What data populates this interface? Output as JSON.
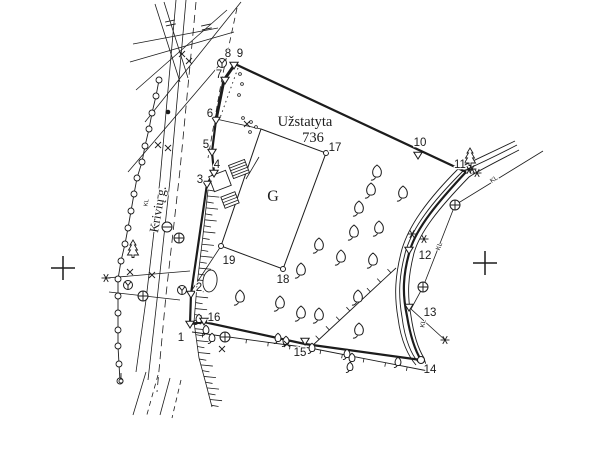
{
  "map": {
    "width": 600,
    "height": 450,
    "colors": {
      "ink": "#1c1c1c",
      "bg": "#ffffff"
    },
    "texts": [
      {
        "id": "builtup-label",
        "text": "Užstatyta",
        "x": 305,
        "y": 126,
        "size": 14.5,
        "font": "serif",
        "rot": 0
      },
      {
        "id": "builtup-area-value",
        "text": "736",
        "x": 313,
        "y": 142,
        "size": 14.5,
        "font": "serif",
        "rot": 0
      },
      {
        "id": "building-label",
        "text": "G",
        "x": 273,
        "y": 201,
        "size": 16,
        "font": "serif",
        "rot": 0
      },
      {
        "id": "street-name",
        "text": "Krivių g.",
        "x": 162,
        "y": 210,
        "size": 13,
        "font": "serif",
        "rot": -80
      },
      {
        "id": "cable-label-1",
        "text": "KL",
        "x": 495,
        "y": 181,
        "size": 6.5,
        "font": "sans",
        "rot": -33
      },
      {
        "id": "cable-label-2",
        "text": "KL",
        "x": 441,
        "y": 247,
        "size": 6.5,
        "font": "sans",
        "rot": -70
      },
      {
        "id": "cable-label-3",
        "text": "KL",
        "x": 425,
        "y": 324,
        "size": 6.5,
        "font": "sans",
        "rot": -80
      },
      {
        "id": "cable-label-4",
        "text": "KL",
        "x": 148,
        "y": 203,
        "size": 6,
        "font": "sans",
        "rot": -80
      }
    ],
    "points": [
      {
        "id": "1",
        "x": 190,
        "y": 324,
        "lx": 181,
        "ly": 341,
        "marker": "triangle"
      },
      {
        "id": "2",
        "x": 191,
        "y": 294,
        "lx": 199,
        "ly": 291,
        "marker": "triangle"
      },
      {
        "id": "3",
        "x": 207,
        "y": 184,
        "lx": 200,
        "ly": 183,
        "marker": "triangle"
      },
      {
        "id": "4",
        "x": 214,
        "y": 173,
        "lx": 217,
        "ly": 168,
        "marker": "triangle"
      },
      {
        "id": "5",
        "x": 212,
        "y": 152,
        "lx": 206,
        "ly": 148,
        "marker": "triangle"
      },
      {
        "id": "6",
        "x": 216,
        "y": 120,
        "lx": 210,
        "ly": 117,
        "marker": "triangle"
      },
      {
        "id": "7",
        "x": 225,
        "y": 80,
        "lx": 219,
        "ly": 78,
        "marker": "triangle"
      },
      {
        "id": "8",
        "x": 222,
        "y": 63,
        "lx": 228,
        "ly": 57,
        "marker": "pole"
      },
      {
        "id": "9",
        "x": 234,
        "y": 65,
        "lx": 240,
        "ly": 57,
        "marker": "triangle"
      },
      {
        "id": "10",
        "x": 418,
        "y": 155,
        "lx": 420,
        "ly": 146,
        "marker": "triangle"
      },
      {
        "id": "11",
        "x": 469,
        "y": 170,
        "lx": 460,
        "ly": 168,
        "marker": "star"
      },
      {
        "id": "12",
        "x": 409,
        "y": 250,
        "lx": 425,
        "ly": 259,
        "marker": "triangle"
      },
      {
        "id": "13",
        "x": 409,
        "y": 307,
        "lx": 430,
        "ly": 316,
        "marker": "triangle"
      },
      {
        "id": "14",
        "x": 421,
        "y": 360,
        "lx": 430,
        "ly": 373,
        "marker": "circle"
      },
      {
        "id": "15",
        "x": 305,
        "y": 341,
        "lx": 300,
        "ly": 356,
        "marker": "triangle"
      },
      {
        "id": "16",
        "x": 204,
        "y": 321,
        "lx": 214,
        "ly": 321,
        "marker": "triangle"
      },
      {
        "id": "17",
        "x": 326,
        "y": 153,
        "lx": 335,
        "ly": 151,
        "marker": "circle-small"
      },
      {
        "id": "18",
        "x": 283,
        "y": 269,
        "lx": 283,
        "ly": 283,
        "marker": "circle-small"
      },
      {
        "id": "19",
        "x": 221,
        "y": 246,
        "lx": 229,
        "ly": 264,
        "marker": "circle-small"
      }
    ],
    "boundary_heavy": [
      [
        [
          235,
          64
        ],
        [
          224,
          80
        ],
        [
          216,
          120
        ]
      ]
    ],
    "boundary_segments": [
      [
        [
          216,
          120
        ],
        [
          212,
          152
        ],
        [
          214,
          173
        ],
        [
          207,
          184
        ],
        [
          191,
          294
        ],
        [
          190,
          324
        ]
      ],
      [
        [
          235,
          64
        ],
        [
          466,
          172
        ]
      ],
      [
        [
          421,
          360
        ],
        [
          305,
          344
        ],
        [
          204,
          322
        ],
        [
          190,
          324
        ]
      ]
    ],
    "boundary_curve": "M466,172 C438,202 417,227 410,250 C403,274 402,293 407,316 C411,340 416,352 421,360",
    "inner_plot": [
      [
        261,
        129
      ],
      [
        326,
        153
      ],
      [
        283,
        269
      ],
      [
        221,
        246
      ]
    ],
    "connectors": [
      [
        216,
        119,
        261,
        129
      ],
      [
        221,
        246,
        192,
        290
      ],
      [
        246,
        179,
        259,
        157
      ]
    ],
    "annexes": [
      {
        "cx": 239,
        "cy": 169,
        "w": 17,
        "h": 14,
        "rot": -21,
        "rungs": 4
      },
      {
        "cx": 220,
        "cy": 181,
        "w": 18,
        "h": 16,
        "rot": -21,
        "rungs": 0
      },
      {
        "cx": 230,
        "cy": 200,
        "w": 15,
        "h": 12,
        "rot": -21,
        "rungs": 3
      }
    ],
    "road_curves": [
      "M517,145 C488,160 472,167 463,171 C430,204 413,228 406,250 C399,275 398,294 402,317 C405,341 412,355 418,362",
      "M519,150 C492,164 476,172 469,177 C438,209 420,232 414,253 C408,277 407,294 411,316 C414,337 419,350 424,358 L428,372",
      "M515,141 C486,155 468,163 459,168 C426,201 409,226 402,249 C395,275 394,295 398,318 C401,342 409,357 416,365"
    ],
    "cable_line": [
      [
        543,
        151
      ],
      [
        455,
        205
      ],
      [
        423,
        287
      ],
      [
        411,
        309
      ],
      [
        445,
        340
      ]
    ],
    "thin_lines": [
      [
        106,
        278,
        190,
        271
      ],
      [
        109,
        292,
        180,
        300
      ],
      [
        145,
        122,
        241,
        2
      ],
      [
        136,
        90,
        227,
        10
      ],
      [
        130,
        62,
        234,
        32
      ],
      [
        155,
        4,
        180,
        82
      ],
      [
        164,
        2,
        188,
        78
      ],
      [
        128,
        172,
        222,
        62
      ],
      [
        133,
        44,
        218,
        28
      ]
    ],
    "street_lines": [
      [
        [
          176,
          0
        ],
        [
          160,
          180
        ],
        [
          146,
          300
        ],
        [
          136,
          372
        ]
      ],
      [
        [
          186,
          0
        ],
        [
          170,
          180
        ],
        [
          157,
          300
        ],
        [
          148,
          380
        ]
      ],
      [
        [
          146,
          372
        ],
        [
          133,
          415
        ]
      ],
      [
        [
          170,
          378
        ],
        [
          160,
          415
        ]
      ]
    ],
    "dashed_lines": [
      {
        "pts": [
          [
            196,
            2
          ],
          [
            180,
            170
          ],
          [
            166,
            295
          ],
          [
            157,
            392
          ]
        ],
        "dash": "8 5"
      },
      {
        "pts": [
          [
            237,
            8
          ],
          [
            222,
            78
          ],
          [
            208,
            158
          ]
        ],
        "dash": "6 4"
      },
      {
        "pts": [
          [
            158,
            375
          ],
          [
            146,
            418
          ]
        ],
        "dash": "5 4"
      },
      {
        "pts": [
          [
            181,
            380
          ],
          [
            172,
            418
          ]
        ],
        "dash": "5 4"
      }
    ],
    "dotted_lines": [
      {
        "pts": [
          [
            238,
            68
          ],
          [
            220,
            118
          ]
        ],
        "dash": "1.5 3.5"
      }
    ],
    "fences": [
      {
        "pts": [
          [
            192,
            332
          ],
          [
            310,
            348
          ],
          [
            428,
            371
          ]
        ],
        "tick": 4,
        "gap": 22
      },
      {
        "pts": [
          [
            396,
            268
          ],
          [
            312,
            346
          ]
        ],
        "tick": 5,
        "gap": 14
      }
    ],
    "post_fence": {
      "posts": [
        [
          159,
          80
        ],
        [
          156,
          96
        ],
        [
          152,
          113
        ],
        [
          149,
          129
        ],
        [
          145,
          146
        ],
        [
          142,
          162
        ],
        [
          137,
          178
        ],
        [
          134,
          194
        ],
        [
          131,
          211
        ],
        [
          128,
          228
        ],
        [
          125,
          244
        ],
        [
          121,
          261
        ],
        [
          118,
          279
        ],
        [
          118,
          296
        ],
        [
          118,
          313
        ],
        [
          118,
          330
        ],
        [
          118,
          346
        ],
        [
          119,
          364
        ],
        [
          120,
          381
        ]
      ]
    },
    "slope_hatch": {
      "pts": [
        [
          208,
          190
        ],
        [
          203,
          235
        ],
        [
          197,
          285
        ],
        [
          194,
          322
        ],
        [
          199,
          358
        ],
        [
          206,
          384
        ],
        [
          212,
          407
        ]
      ],
      "step": 6,
      "len_a": 12,
      "len_b": 7
    },
    "trees_deciduous": [
      [
        377,
        172
      ],
      [
        371,
        190
      ],
      [
        403,
        193
      ],
      [
        359,
        208
      ],
      [
        354,
        232
      ],
      [
        379,
        228
      ],
      [
        319,
        245
      ],
      [
        341,
        257
      ],
      [
        373,
        260
      ],
      [
        301,
        270
      ],
      [
        280,
        303
      ],
      [
        301,
        313
      ],
      [
        319,
        315
      ],
      [
        358,
        297
      ],
      [
        359,
        330
      ],
      [
        240,
        297
      ]
    ],
    "trees_deciduous_small": [
      [
        312,
        348
      ],
      [
        347,
        354
      ],
      [
        352,
        358
      ],
      [
        398,
        362
      ],
      [
        350,
        367
      ],
      [
        199,
        319
      ],
      [
        206,
        330
      ],
      [
        212,
        338
      ],
      [
        278,
        338
      ],
      [
        286,
        341
      ]
    ],
    "trees_conifer": [
      [
        470,
        157
      ],
      [
        133,
        249
      ]
    ],
    "bush_oval": {
      "cx": 210,
      "cy": 281,
      "rx": 7,
      "ry": 11,
      "rot": 8
    },
    "manholes": [
      [
        455,
        205
      ],
      [
        423,
        287
      ],
      [
        225,
        337
      ],
      [
        143,
        296
      ],
      [
        179,
        238
      ]
    ],
    "minus_circles": [
      [
        167,
        227
      ]
    ],
    "poles_y": [
      [
        222,
        63
      ],
      [
        182,
        290
      ],
      [
        128,
        285
      ]
    ],
    "sapling": [
      [
        121,
        381
      ]
    ],
    "stars": [
      [
        472,
        169
      ],
      [
        477,
        173
      ],
      [
        445,
        340
      ],
      [
        412,
        234
      ],
      [
        424,
        239
      ],
      [
        106,
        278
      ]
    ],
    "x_marks": [
      [
        130,
        272
      ],
      [
        152,
        275
      ],
      [
        158,
        145
      ],
      [
        168,
        148
      ],
      [
        287,
        344
      ],
      [
        222,
        349
      ],
      [
        182,
        54
      ],
      [
        189,
        61
      ],
      [
        247,
        124
      ]
    ],
    "dots_small": [
      [
        251,
        122
      ],
      [
        256,
        127
      ],
      [
        250,
        132
      ],
      [
        243,
        118
      ],
      [
        240,
        74
      ],
      [
        242,
        84
      ],
      [
        239,
        95
      ]
    ],
    "filled_dots": [
      [
        168,
        112
      ]
    ],
    "tick_pairs": [
      [
        170,
        21
      ],
      [
        206,
        25
      ]
    ],
    "grid_crosses": [
      [
        63,
        268
      ],
      [
        485,
        263
      ]
    ]
  }
}
